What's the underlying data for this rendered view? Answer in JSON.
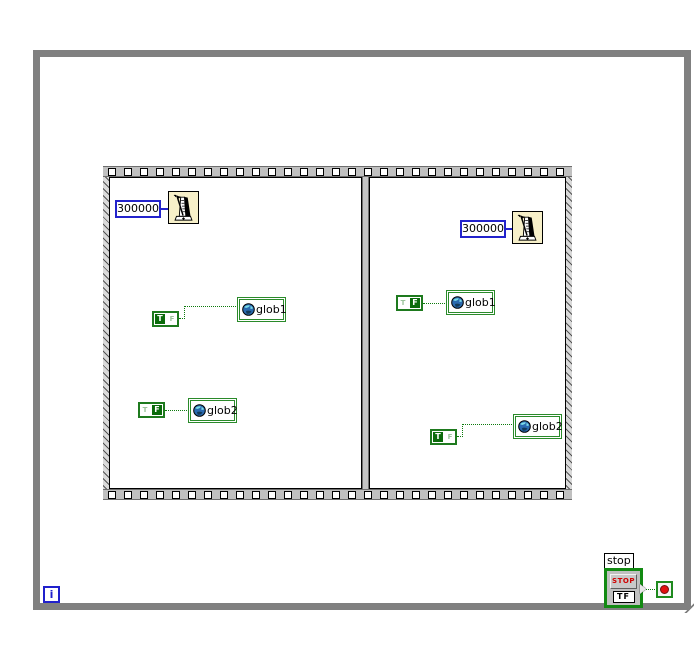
{
  "loop": {
    "iteration_label": "i"
  },
  "sequence": {
    "frames": [
      {
        "wait_ms": "300000",
        "writes": [
          {
            "selected": "T",
            "true_letter": "T",
            "false_letter": "F",
            "global": "glob1"
          },
          {
            "selected": "F",
            "true_letter": "T",
            "false_letter": "F",
            "global": "glob2"
          }
        ]
      },
      {
        "wait_ms": "300000",
        "writes": [
          {
            "selected": "F",
            "true_letter": "T",
            "false_letter": "F",
            "global": "glob1"
          },
          {
            "selected": "T",
            "true_letter": "T",
            "false_letter": "F",
            "global": "glob2"
          }
        ]
      }
    ]
  },
  "stop_control": {
    "label": "stop",
    "button_text": "STOP",
    "datatype": "TF"
  },
  "icons": {
    "wait_function": "metronome-icon",
    "global_variable": "globe-icon",
    "loop_condition": "stop-sign-icon"
  },
  "colors": {
    "loop_border_gray": "#808080",
    "structure_green": "#2a8a2a",
    "boolean_green": "#0b6b0b",
    "numeric_blue": "#2323cc",
    "wire_green": "#0d7a0d",
    "wait_icon_bg": "#f7f0c9",
    "stop_text_red": "#d00000",
    "condition_dot_red": "#e01010"
  }
}
